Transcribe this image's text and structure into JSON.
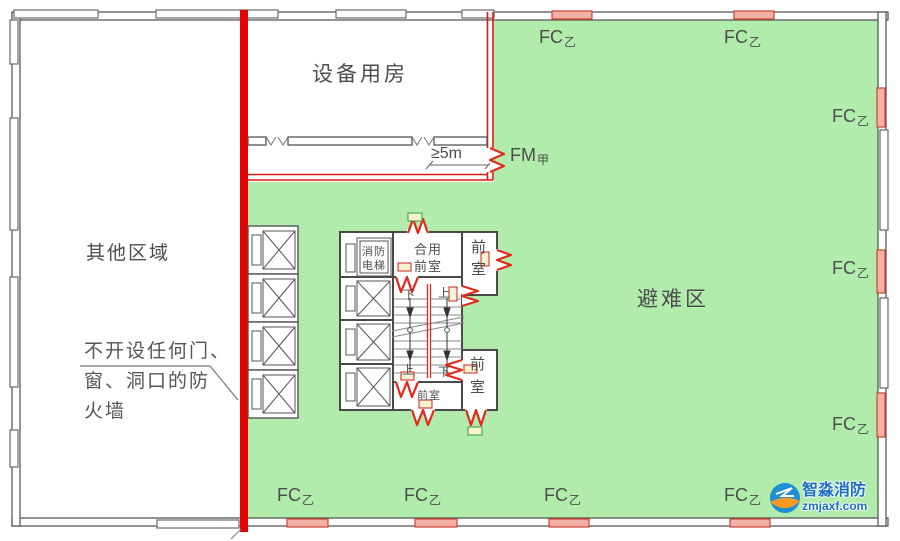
{
  "colors": {
    "refuge_green": "#b2ecac",
    "firewall_red": "#e50300",
    "door_red": "#e02a1c",
    "red_window_fill": "#f4b0a6",
    "wall_gray": "#555555",
    "text_gray": "#4d4d4d",
    "watermark_blue": "#1a6ec2",
    "watermark_orange": "#f59a23"
  },
  "labels": {
    "equipment_room": "设备用房",
    "other_area": "其他区域",
    "refuge_area": "避难区",
    "distance": "≥5m",
    "fire_door": "FM",
    "fire_door_class": "甲",
    "fire_window": "FC",
    "fire_window_class": "乙",
    "fire_elevator_l1": "消防",
    "fire_elevator_l2": "电梯",
    "shared_lobby_l1": "合用",
    "shared_lobby_l2": "前室",
    "lobby": "前室",
    "lobby_c1": "前",
    "lobby_c2": "室",
    "up": "上",
    "down": "下",
    "firewall_note_l1": "不开设任何门、",
    "firewall_note_l2": "窗、洞口的防",
    "firewall_note_l3": "火墙"
  },
  "watermark": {
    "brand": "智淼消防",
    "site": "zmjaxf.com"
  }
}
